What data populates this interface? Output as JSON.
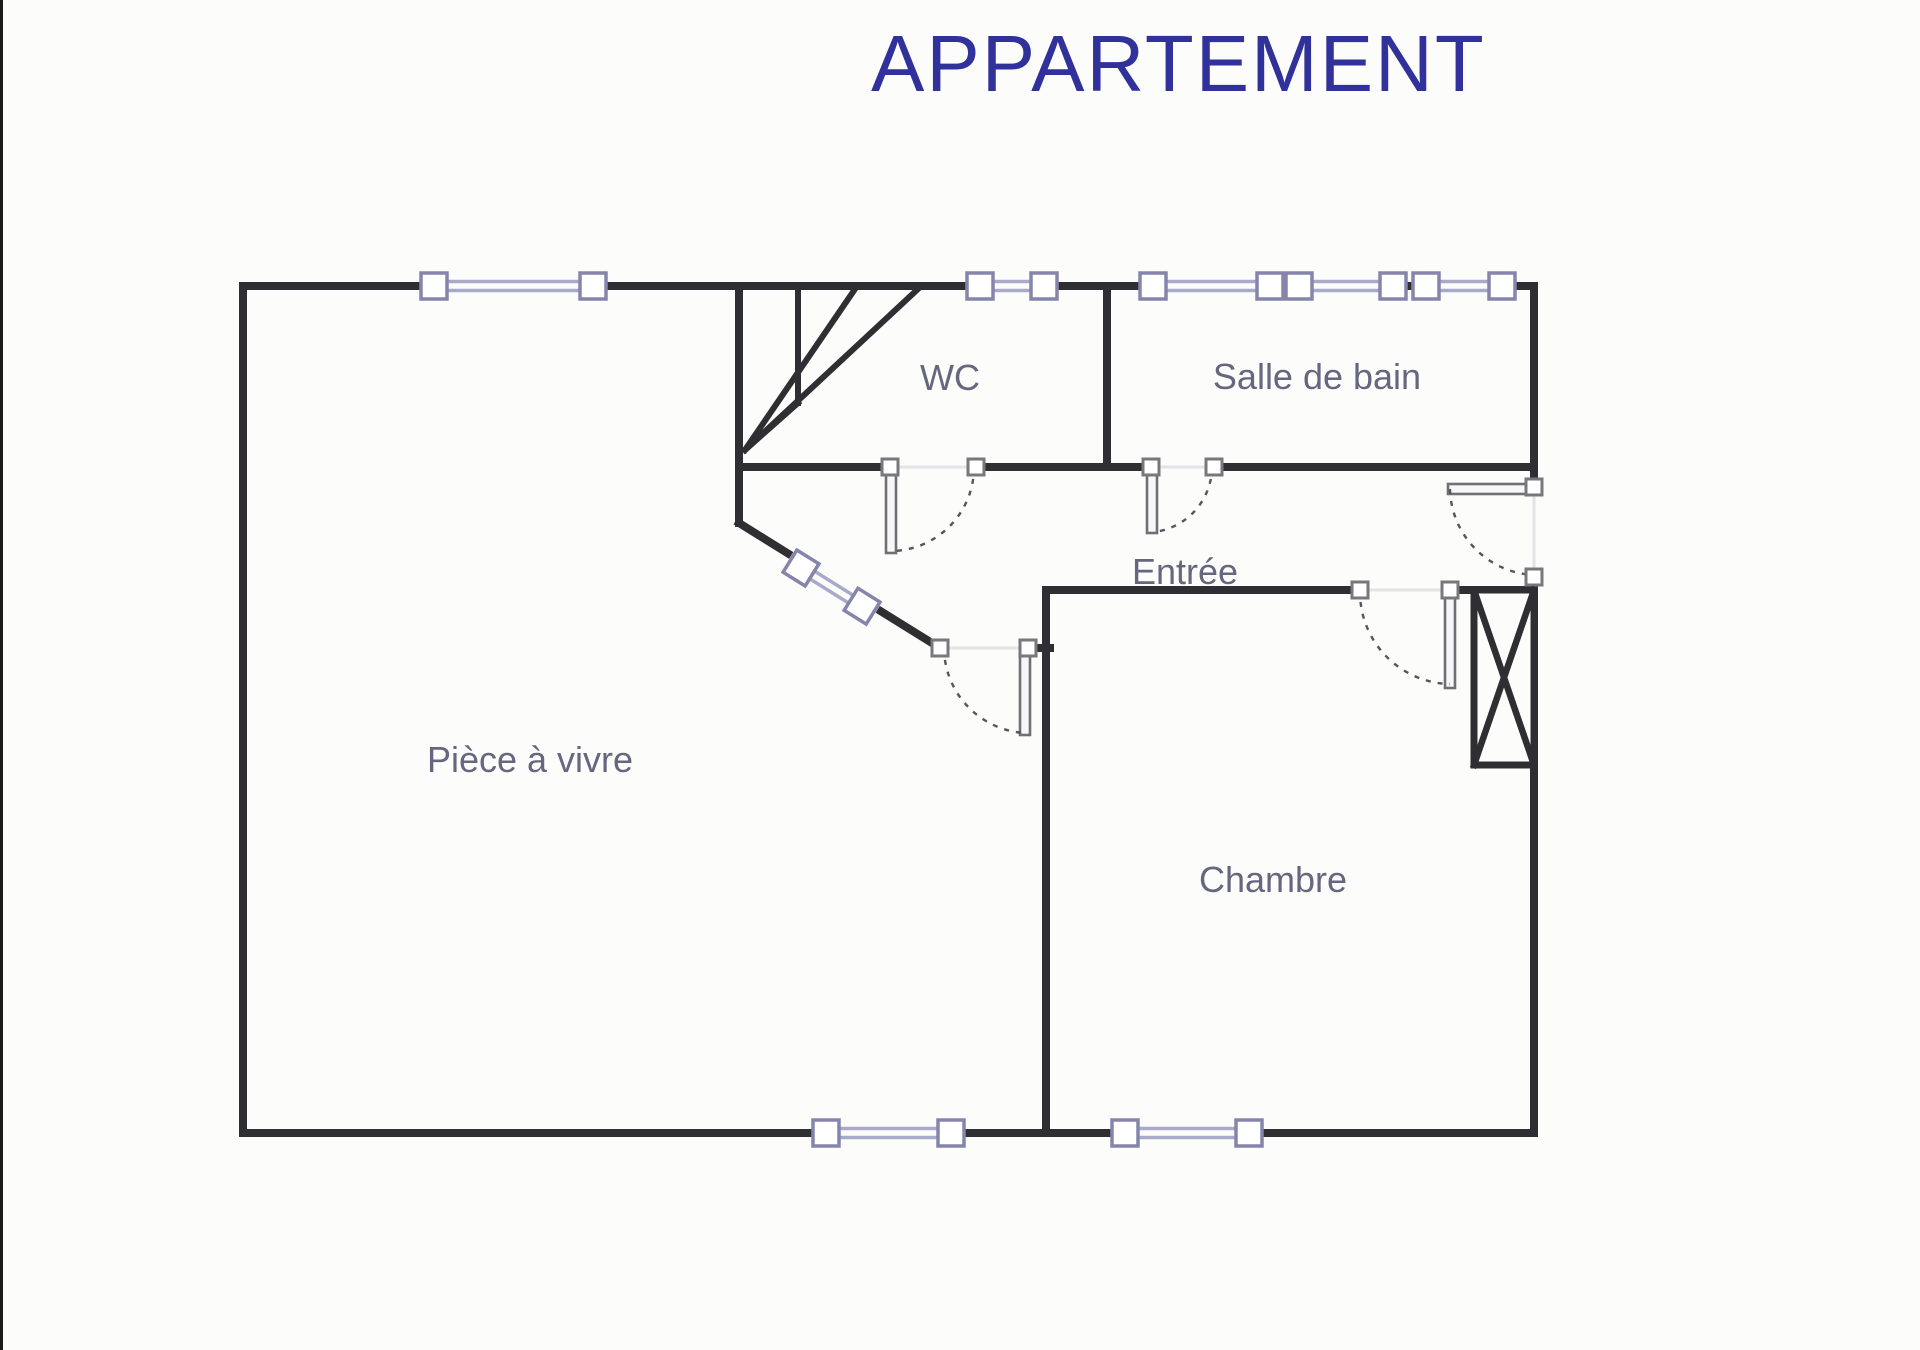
{
  "title": "APPARTEMENT",
  "rooms": {
    "living": "Pièce à vivre",
    "wc": "WC",
    "bathroom": "Salle de bain",
    "entry": "Entrée",
    "bedroom": "Chambre"
  },
  "colors": {
    "background": "#fcfcfb",
    "wall": "#2f2f33",
    "window_frame": "#8585ac",
    "window_glass": "#a9a9cc",
    "door_jamb": "#77777c",
    "door_leaf": "#6f6f74",
    "door_arc": "#55555a",
    "label": "#66667f",
    "title": "#31319b",
    "opening": "#e4e4e6"
  }
}
